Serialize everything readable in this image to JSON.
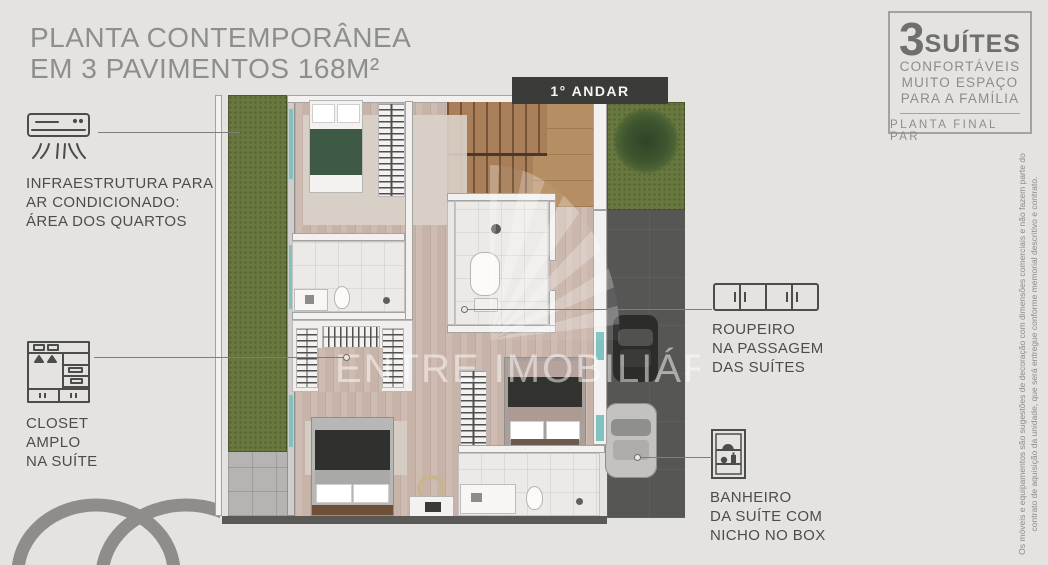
{
  "header": {
    "title_line1": "PLANTA CONTEMPORÂNEA",
    "title_line2": "EM 3 PAVIMENTOS 168M²"
  },
  "floor_banner": "1° ANDAR",
  "annotations": {
    "ac": {
      "lines": [
        "INFRAESTRUTURA PARA",
        "AR CONDICIONADO:",
        "ÁREA DOS QUARTOS"
      ]
    },
    "closet": {
      "lines": [
        "CLOSET",
        "AMPLO",
        "NA SUÍTE"
      ]
    },
    "roupeiro": {
      "lines": [
        "ROUPEIRO",
        "NA PASSAGEM",
        "DAS SUÍTES"
      ]
    },
    "banheiro": {
      "lines": [
        "BANHEIRO",
        "DA SUÍTE COM",
        "NICHO NO BOX"
      ]
    }
  },
  "badge": {
    "number": "3",
    "word": "SUÍTES",
    "lines": [
      "CONFORTÁVEIS",
      "MUITO ESPAÇO",
      "PARA A FAMÍLIA"
    ],
    "footer": "PLANTA FINAL PAR"
  },
  "watermark": "ENTRE IMOBILIÁRIA",
  "disclaimer": {
    "line1": "Os móveis e equipamentos são sugestões de decoração com dimensões comerciais e não fazem parte do",
    "line2": "contrato de aquisição da unidade, que será entregue conforme memorial descritivo e contrato."
  },
  "colors": {
    "background": "#e4e3e1",
    "title_gray": "#8e8e8c",
    "annotation_gray": "#4c4c4a",
    "banner_bg": "#3b3b39",
    "banner_text": "#f5f5f3",
    "badge_border": "#a2a2a0",
    "grass": "#68783e",
    "wood_floor": "#c8b3a8",
    "stair_wood": "#a87f58",
    "driveway": "#565655",
    "watermark_white": "rgba(255,255,255,0.5)"
  }
}
